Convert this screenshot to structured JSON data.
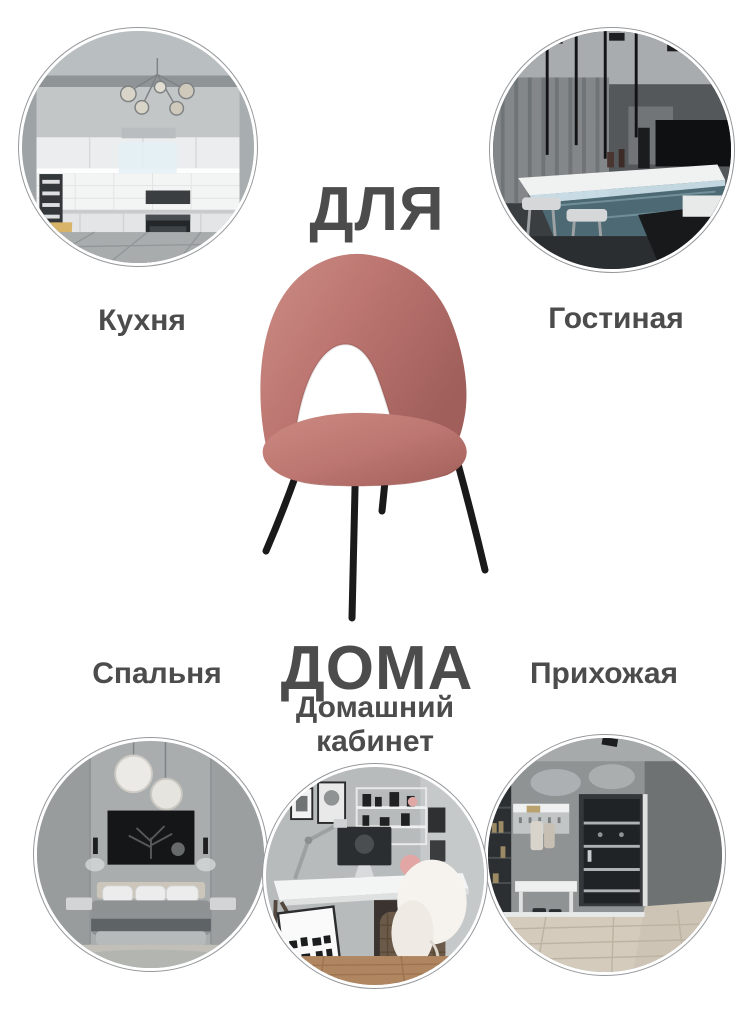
{
  "headline": {
    "top": "ДЛЯ",
    "bottom": "ДОМА"
  },
  "rooms": [
    {
      "id": "kitchen",
      "label": "Кухня",
      "position": "top-left"
    },
    {
      "id": "living-room",
      "label": "Гостиная",
      "position": "top-right"
    },
    {
      "id": "bedroom",
      "label": "Спальня",
      "position": "bottom-left"
    },
    {
      "id": "home-office",
      "label": "Домашний кабинет",
      "position": "bottom-center"
    },
    {
      "id": "hallway",
      "label": "Прихожая",
      "position": "bottom-right"
    }
  ],
  "colors": {
    "background": "#ffffff",
    "text": "#4c4c4c",
    "circle_ring": "#96999c",
    "chair_velvet": "#bd7671",
    "chair_velvet_highlight": "#cb8d85",
    "chair_velvet_shadow": "#a05f5b",
    "chair_legs": "#1a1a1a"
  }
}
